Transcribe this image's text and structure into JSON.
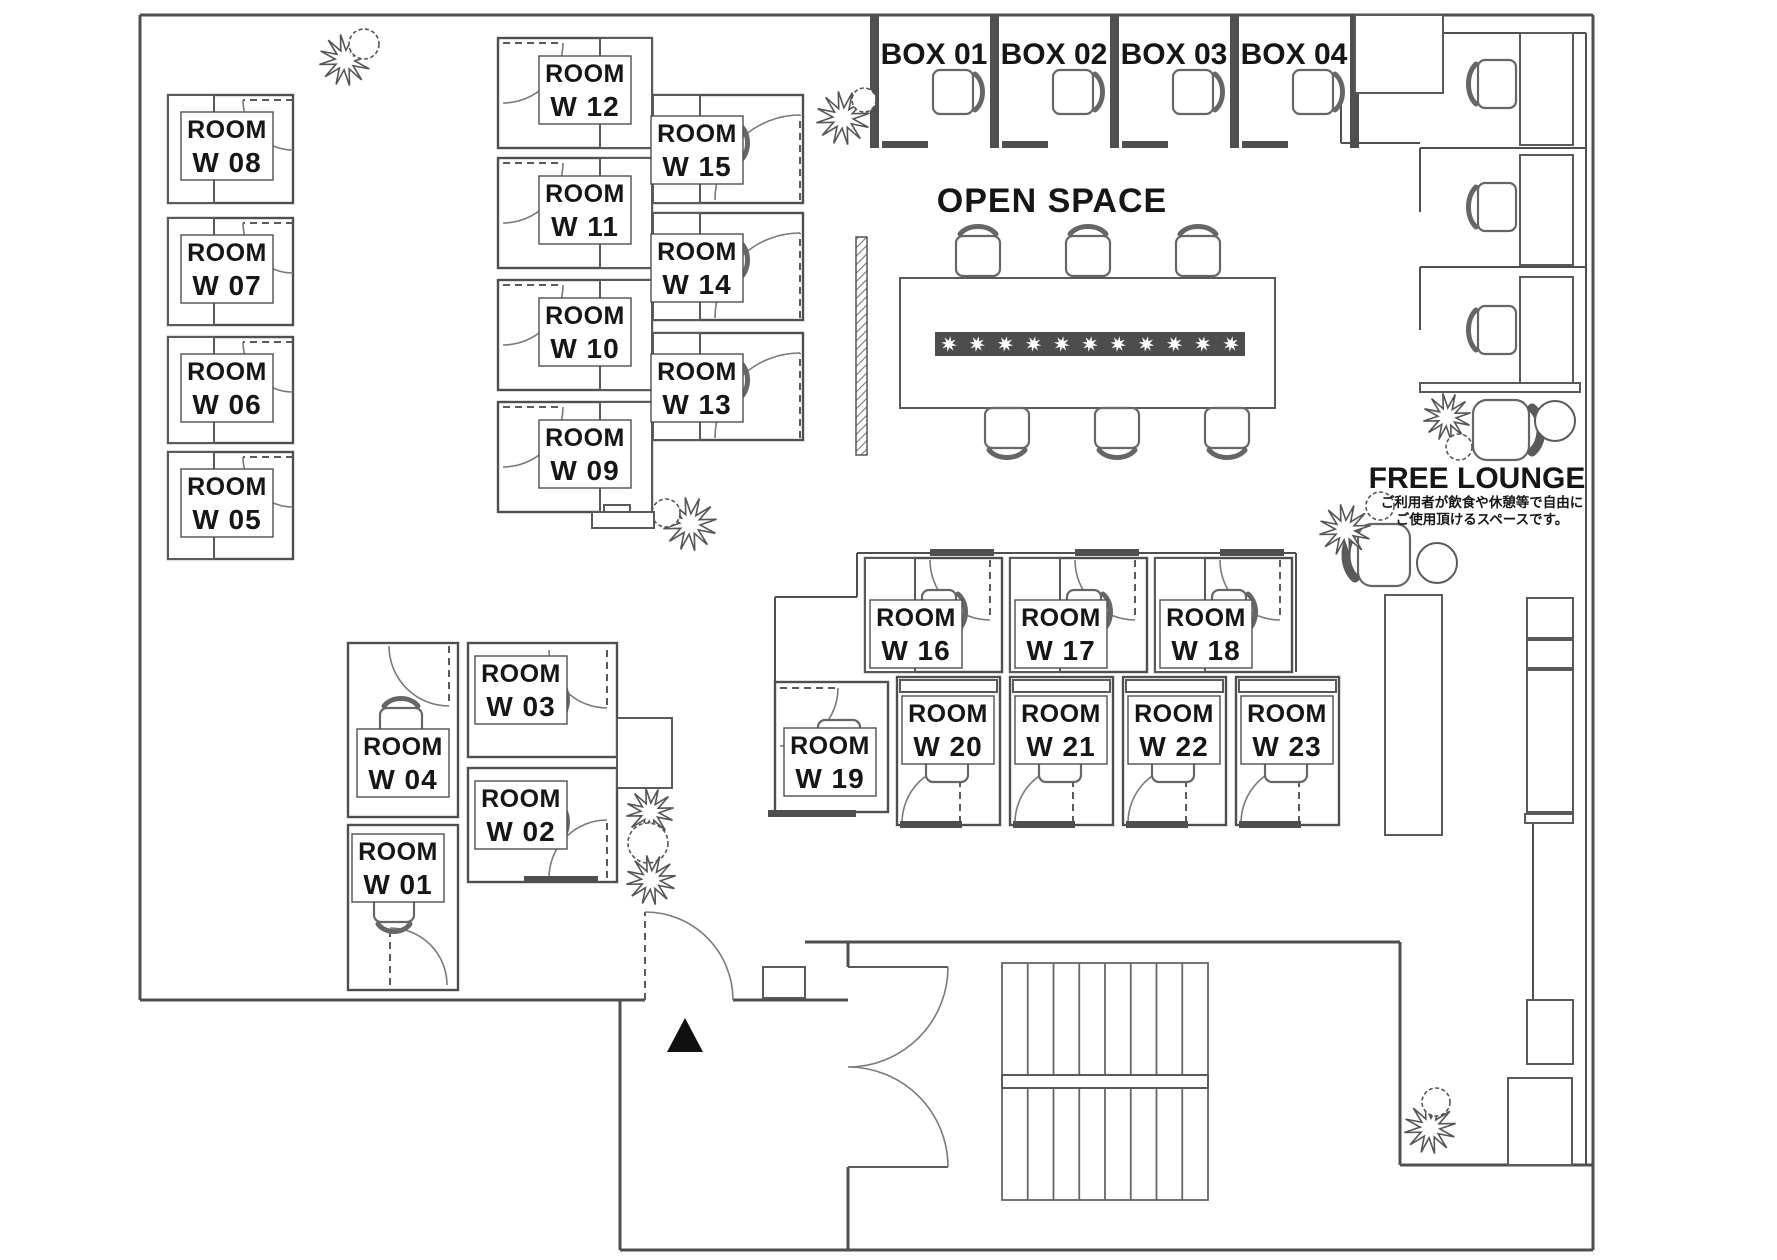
{
  "plan": {
    "open_space_label": "OPEN SPACE",
    "free_lounge": {
      "label": "FREE LOUNGE",
      "note_line1": "ご利用者が飲食や休憩等で自由に",
      "note_line2": "ご使用頂けるスペースです。",
      "note_color": "#d93a2d"
    },
    "wall_color": "#4f4f4f",
    "entrance": {
      "marker": "triangle",
      "door": {
        "h": [
          645,
          1000
        ],
        "r": 88,
        "d1": [
          0,
          -1
        ],
        "d2": [
          1,
          0
        ],
        "s": 1
      },
      "tri": [
        [
          667,
          1052
        ],
        [
          703,
          1052
        ],
        [
          685,
          1018
        ]
      ]
    }
  },
  "boxes": [
    {
      "label": "BOX 01",
      "px": 870
    },
    {
      "label": "BOX 02",
      "px": 990
    },
    {
      "label": "BOX 03",
      "px": 1110
    },
    {
      "label": "BOX 04",
      "px": 1230
    }
  ],
  "rooms": [
    {
      "line1": "ROOM",
      "line2": "W 01",
      "rect": [
        348,
        825,
        110,
        165
      ],
      "desk": null,
      "chair": [
        374,
        894,
        40,
        28,
        "bottom"
      ],
      "door": {
        "h": [
          390,
          985
        ],
        "r": 57,
        "d1": [
          0,
          -1
        ],
        "d2": [
          1,
          0
        ],
        "s": 1
      },
      "label": [
        398,
        868
      ],
      "sill": null
    },
    {
      "line1": "ROOM",
      "line2": "W 02",
      "rect": [
        468,
        768,
        149,
        114
      ],
      "desk": null,
      "chair": [
        522,
        800,
        36,
        44,
        "right"
      ],
      "door": {
        "h": [
          607,
          878
        ],
        "r": 58,
        "d1": [
          0,
          -1
        ],
        "d2": [
          -1,
          0
        ],
        "s": 0
      },
      "label": [
        521,
        815
      ],
      "sill": [
        524,
        876,
        74,
        7
      ]
    },
    {
      "line1": "ROOM",
      "line2": "W 03",
      "rect": [
        468,
        643,
        149,
        114
      ],
      "desk": null,
      "chair": [
        522,
        678,
        36,
        44,
        "right"
      ],
      "door": {
        "h": [
          607,
          650
        ],
        "r": 58,
        "d1": [
          0,
          1
        ],
        "d2": [
          -1,
          0
        ],
        "s": 1
      },
      "label": [
        521,
        690
      ],
      "sill": null
    },
    {
      "line1": "ROOM",
      "line2": "W 04",
      "rect": [
        348,
        643,
        110,
        174
      ],
      "desk": null,
      "chair": [
        380,
        708,
        42,
        30,
        "top"
      ],
      "door": {
        "h": [
          449,
          646
        ],
        "r": 60,
        "d1": [
          0,
          1
        ],
        "d2": [
          -1,
          0
        ],
        "s": 1
      },
      "label": [
        403,
        763
      ],
      "sill": null
    },
    {
      "line1": "ROOM",
      "line2": "W 05",
      "rect": [
        168,
        452,
        125,
        107
      ],
      "desk": [
        168,
        452,
        46,
        107
      ],
      "chair": [
        216,
        478,
        34,
        44,
        "right"
      ],
      "door": {
        "h": [
          293,
          457
        ],
        "r": 50,
        "d1": [
          -1,
          0
        ],
        "d2": [
          0,
          1
        ],
        "s": 0
      },
      "label": [
        227,
        503
      ],
      "sill": null
    },
    {
      "line1": "ROOM",
      "line2": "W 06",
      "rect": [
        168,
        337,
        125,
        106
      ],
      "desk": [
        168,
        337,
        46,
        106
      ],
      "chair": [
        216,
        362,
        34,
        44,
        "right"
      ],
      "door": {
        "h": [
          293,
          342
        ],
        "r": 50,
        "d1": [
          -1,
          0
        ],
        "d2": [
          0,
          1
        ],
        "s": 0
      },
      "label": [
        227,
        388
      ],
      "sill": null
    },
    {
      "line1": "ROOM",
      "line2": "W 07",
      "rect": [
        168,
        218,
        125,
        107
      ],
      "desk": [
        168,
        218,
        46,
        107
      ],
      "chair": [
        216,
        244,
        34,
        44,
        "right"
      ],
      "door": {
        "h": [
          293,
          223
        ],
        "r": 50,
        "d1": [
          -1,
          0
        ],
        "d2": [
          0,
          1
        ],
        "s": 0
      },
      "label": [
        227,
        269
      ],
      "sill": null
    },
    {
      "line1": "ROOM",
      "line2": "W 08",
      "rect": [
        168,
        95,
        125,
        108
      ],
      "desk": [
        168,
        95,
        46,
        108
      ],
      "chair": [
        216,
        122,
        34,
        44,
        "right"
      ],
      "door": {
        "h": [
          293,
          100
        ],
        "r": 50,
        "d1": [
          -1,
          0
        ],
        "d2": [
          0,
          1
        ],
        "s": 0
      },
      "label": [
        227,
        146
      ],
      "sill": null
    },
    {
      "line1": "ROOM",
      "line2": "W 09",
      "rect": [
        498,
        402,
        154,
        110
      ],
      "desk": [
        600,
        402,
        52,
        110
      ],
      "chair": [
        556,
        428,
        34,
        44,
        "left"
      ],
      "door": {
        "h": [
          503,
          407
        ],
        "r": 60,
        "d1": [
          1,
          0
        ],
        "d2": [
          0,
          1
        ],
        "s": 1
      },
      "label": [
        585,
        454
      ],
      "sill": null
    },
    {
      "line1": "ROOM",
      "line2": "W 10",
      "rect": [
        498,
        280,
        154,
        110
      ],
      "desk": [
        600,
        280,
        52,
        110
      ],
      "chair": [
        556,
        306,
        34,
        44,
        "left"
      ],
      "door": {
        "h": [
          503,
          285
        ],
        "r": 60,
        "d1": [
          1,
          0
        ],
        "d2": [
          0,
          1
        ],
        "s": 1
      },
      "label": [
        585,
        332
      ],
      "sill": null
    },
    {
      "line1": "ROOM",
      "line2": "W 11",
      "rect": [
        498,
        158,
        154,
        110
      ],
      "desk": [
        600,
        158,
        52,
        110
      ],
      "chair": [
        556,
        184,
        34,
        44,
        "left"
      ],
      "door": {
        "h": [
          503,
          163
        ],
        "r": 60,
        "d1": [
          1,
          0
        ],
        "d2": [
          0,
          1
        ],
        "s": 1
      },
      "label": [
        585,
        210
      ],
      "sill": null
    },
    {
      "line1": "ROOM",
      "line2": "W 12",
      "rect": [
        498,
        38,
        154,
        110
      ],
      "desk": [
        600,
        38,
        52,
        110
      ],
      "chair": [
        556,
        64,
        34,
        44,
        "left"
      ],
      "door": {
        "h": [
          503,
          43
        ],
        "r": 60,
        "d1": [
          1,
          0
        ],
        "d2": [
          0,
          1
        ],
        "s": 1
      },
      "label": [
        585,
        90
      ],
      "sill": null
    },
    {
      "line1": "ROOM",
      "line2": "W 13",
      "rect": [
        653,
        333,
        150,
        107
      ],
      "desk": [
        653,
        333,
        47,
        107
      ],
      "chair": [
        704,
        358,
        34,
        44,
        "right"
      ],
      "door": {
        "h": [
          800,
          438
        ],
        "r": 85,
        "d1": [
          0,
          -1
        ],
        "d2": [
          -1,
          0
        ],
        "s": 0
      },
      "label": [
        697,
        388
      ],
      "sill": null
    },
    {
      "line1": "ROOM",
      "line2": "W 14",
      "rect": [
        653,
        213,
        150,
        107
      ],
      "desk": [
        653,
        213,
        47,
        107
      ],
      "chair": [
        704,
        238,
        34,
        44,
        "right"
      ],
      "door": {
        "h": [
          800,
          318
        ],
        "r": 85,
        "d1": [
          0,
          -1
        ],
        "d2": [
          -1,
          0
        ],
        "s": 0
      },
      "label": [
        697,
        268
      ],
      "sill": null
    },
    {
      "line1": "ROOM",
      "line2": "W 15",
      "rect": [
        653,
        95,
        150,
        108
      ],
      "desk": [
        653,
        95,
        47,
        108
      ],
      "chair": [
        704,
        121,
        34,
        44,
        "right"
      ],
      "door": {
        "h": [
          800,
          200
        ],
        "r": 85,
        "d1": [
          0,
          -1
        ],
        "d2": [
          -1,
          0
        ],
        "s": 0
      },
      "label": [
        697,
        150
      ],
      "sill": null
    },
    {
      "line1": "ROOM",
      "line2": "W 16",
      "rect": [
        865,
        558,
        137,
        114
      ],
      "desk": [
        865,
        558,
        50,
        114
      ],
      "chair": [
        922,
        590,
        34,
        44,
        "right"
      ],
      "door": {
        "h": [
          990,
          560
        ],
        "r": 60,
        "d1": [
          0,
          1
        ],
        "d2": [
          -1,
          0
        ],
        "s": 1
      },
      "label": [
        916,
        634
      ],
      "sill": [
        930,
        549,
        64,
        7
      ]
    },
    {
      "line1": "ROOM",
      "line2": "W 17",
      "rect": [
        1010,
        558,
        137,
        114
      ],
      "desk": [
        1010,
        558,
        50,
        114
      ],
      "chair": [
        1067,
        590,
        34,
        44,
        "right"
      ],
      "door": {
        "h": [
          1135,
          560
        ],
        "r": 60,
        "d1": [
          0,
          1
        ],
        "d2": [
          -1,
          0
        ],
        "s": 1
      },
      "label": [
        1061,
        634
      ],
      "sill": [
        1075,
        549,
        64,
        7
      ]
    },
    {
      "line1": "ROOM",
      "line2": "W 18",
      "rect": [
        1155,
        558,
        137,
        114
      ],
      "desk": [
        1155,
        558,
        50,
        114
      ],
      "chair": [
        1212,
        590,
        34,
        44,
        "right"
      ],
      "door": {
        "h": [
          1280,
          560
        ],
        "r": 60,
        "d1": [
          0,
          1
        ],
        "d2": [
          -1,
          0
        ],
        "s": 1
      },
      "label": [
        1206,
        634
      ],
      "sill": [
        1220,
        549,
        64,
        7
      ]
    },
    {
      "line1": "ROOM",
      "line2": "W 19",
      "rect": [
        775,
        682,
        113,
        130
      ],
      "desk": null,
      "chair": [
        818,
        720,
        42,
        30,
        "bottom"
      ],
      "door": {
        "h": [
          780,
          688
        ],
        "r": 58,
        "d1": [
          1,
          0
        ],
        "d2": [
          0,
          1
        ],
        "s": 1
      },
      "label": [
        830,
        762
      ],
      "sill": [
        768,
        810,
        88,
        7
      ]
    },
    {
      "line1": "ROOM",
      "line2": "W 20",
      "rect": [
        897,
        677,
        103,
        148
      ],
      "desk": [
        900,
        680,
        97,
        12
      ],
      "chair": [
        926,
        752,
        42,
        30,
        "top"
      ],
      "door": {
        "h": [
          960,
          823
        ],
        "r": 58,
        "d1": [
          0,
          -1
        ],
        "d2": [
          -1,
          0
        ],
        "s": 0
      },
      "label": [
        948,
        730
      ],
      "sill": [
        900,
        821,
        62,
        7
      ]
    },
    {
      "line1": "ROOM",
      "line2": "W 21",
      "rect": [
        1010,
        677,
        103,
        148
      ],
      "desk": [
        1013,
        680,
        97,
        12
      ],
      "chair": [
        1039,
        752,
        42,
        30,
        "top"
      ],
      "door": {
        "h": [
          1073,
          823
        ],
        "r": 58,
        "d1": [
          0,
          -1
        ],
        "d2": [
          -1,
          0
        ],
        "s": 0
      },
      "label": [
        1061,
        730
      ],
      "sill": [
        1013,
        821,
        62,
        7
      ]
    },
    {
      "line1": "ROOM",
      "line2": "W 22",
      "rect": [
        1123,
        677,
        103,
        148
      ],
      "desk": [
        1126,
        680,
        97,
        12
      ],
      "chair": [
        1152,
        752,
        42,
        30,
        "top"
      ],
      "door": {
        "h": [
          1186,
          823
        ],
        "r": 58,
        "d1": [
          0,
          -1
        ],
        "d2": [
          -1,
          0
        ],
        "s": 0
      },
      "label": [
        1174,
        730
      ],
      "sill": [
        1126,
        821,
        62,
        7
      ]
    },
    {
      "line1": "ROOM",
      "line2": "W 23",
      "rect": [
        1236,
        677,
        103,
        148
      ],
      "desk": [
        1239,
        680,
        97,
        12
      ],
      "chair": [
        1265,
        752,
        42,
        30,
        "top"
      ],
      "door": {
        "h": [
          1299,
          823
        ],
        "r": 58,
        "d1": [
          0,
          -1
        ],
        "d2": [
          -1,
          0
        ],
        "s": 0
      },
      "label": [
        1287,
        730
      ],
      "sill": [
        1239,
        821,
        62,
        7
      ]
    }
  ],
  "open_space": {
    "table": [
      900,
      278,
      375,
      130
    ],
    "strip": [
      935,
      332,
      310,
      24
    ],
    "strip_stars": 11,
    "chairs": [
      [
        956,
        236,
        44,
        40,
        "top"
      ],
      [
        1066,
        236,
        44,
        40,
        "top"
      ],
      [
        1176,
        236,
        44,
        40,
        "top"
      ],
      [
        985,
        408,
        44,
        40,
        "bottom"
      ],
      [
        1095,
        408,
        44,
        40,
        "bottom"
      ],
      [
        1205,
        408,
        44,
        40,
        "bottom"
      ]
    ],
    "divider": [
      856,
      237,
      11,
      218
    ]
  },
  "cubicles": {
    "desks": [
      [
        1520,
        33,
        53,
        112
      ],
      [
        1520,
        155,
        53,
        110
      ],
      [
        1520,
        277,
        53,
        108
      ]
    ],
    "chairs": [
      [
        1478,
        60,
        38,
        48,
        "left"
      ],
      [
        1478,
        183,
        38,
        48,
        "left"
      ],
      [
        1478,
        306,
        38,
        48,
        "left"
      ]
    ],
    "shelf": [
      1420,
      383,
      160,
      9
    ]
  },
  "lounge": {
    "armchairs": [
      {
        "x": 1473,
        "y": 400,
        "w": 56,
        "h": 60,
        "side": "right"
      },
      {
        "x": 1358,
        "y": 524,
        "w": 52,
        "h": 62,
        "side": "left"
      }
    ],
    "tables": [
      {
        "cx": 1555,
        "cy": 421,
        "r": 20
      },
      {
        "cx": 1437,
        "cy": 563,
        "r": 20
      }
    ]
  },
  "plants": [
    {
      "cx": 345,
      "cy": 60,
      "R": 26,
      "bush": [
        364,
        44,
        15
      ]
    },
    {
      "cx": 843,
      "cy": 118,
      "R": 27,
      "bush": [
        864,
        100,
        12
      ]
    },
    {
      "cx": 1447,
      "cy": 417,
      "R": 24,
      "bush": [
        1459,
        447,
        13
      ]
    },
    {
      "cx": 1345,
      "cy": 530,
      "R": 26,
      "bush": [
        1380,
        506,
        14
      ]
    },
    {
      "cx": 690,
      "cy": 524,
      "R": 27,
      "bush": [
        666,
        513,
        14
      ]
    },
    {
      "cx": 650,
      "cy": 812,
      "R": 24,
      "bush": [
        648,
        843,
        20
      ]
    },
    {
      "cx": 651,
      "cy": 880,
      "R": 25,
      "bush": null
    },
    {
      "cx": 1430,
      "cy": 1128,
      "R": 26,
      "bush": [
        1436,
        1102,
        14
      ]
    }
  ],
  "furniture": [
    {
      "x": 1355,
      "y": 15,
      "w": 88,
      "h": 78,
      "name": "locker"
    },
    {
      "x": 1385,
      "y": 595,
      "w": 57,
      "h": 240,
      "name": "counter"
    },
    {
      "x": 1527,
      "y": 598,
      "w": 46,
      "h": 40,
      "name": "cabinet"
    },
    {
      "x": 1527,
      "y": 640,
      "w": 46,
      "h": 28,
      "name": "cabinet"
    },
    {
      "x": 1527,
      "y": 670,
      "w": 46,
      "h": 142,
      "name": "cabinet"
    },
    {
      "x": 1525,
      "y": 814,
      "w": 48,
      "h": 9,
      "name": "shelf"
    },
    {
      "x": 1527,
      "y": 1000,
      "w": 46,
      "h": 64,
      "name": "cabinet"
    },
    {
      "x": 1508,
      "y": 1078,
      "w": 64,
      "h": 87,
      "name": "cabinet"
    },
    {
      "x": 617,
      "y": 718,
      "w": 55,
      "h": 70,
      "name": "closet"
    },
    {
      "x": 763,
      "y": 967,
      "w": 42,
      "h": 31,
      "name": "step"
    },
    {
      "x": 592,
      "y": 512,
      "w": 62,
      "h": 16,
      "name": "side-table"
    },
    {
      "x": 604,
      "y": 505,
      "w": 26,
      "h": 7,
      "name": "side-table-top"
    }
  ],
  "stairs": {
    "x": 1002,
    "y": 963,
    "w": 206,
    "h": 237,
    "treads": 8,
    "landing": [
      1002,
      1075,
      206,
      13
    ]
  }
}
